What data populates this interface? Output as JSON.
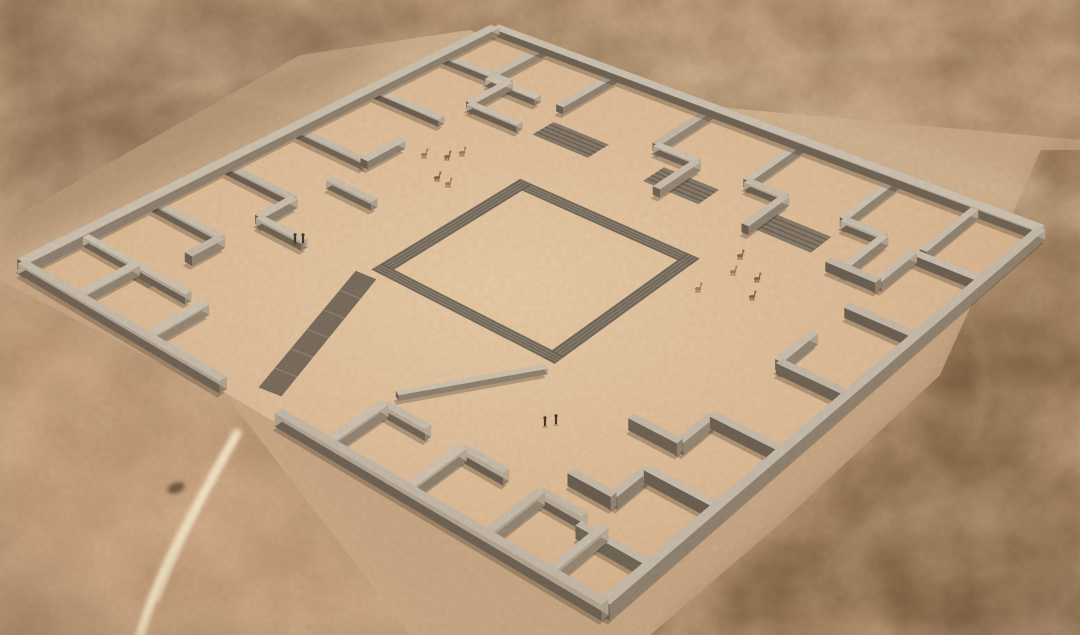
{
  "scene": {
    "label": "Aerial 3D reconstruction of a square walled desert compound with perimeter rooms, a central sunken plaza, stone stair ramps, small human figures and llamas on a sandy plain",
    "width": 1080,
    "height": 635
  },
  "palette": {
    "sand_base": "#c9a987",
    "platform_center": "#e9cda8",
    "platform_mid": "#e0bf9b",
    "platform_edge": "#d5b28c",
    "tint_topleft": "#a98c6f",
    "tint_right_dark": "#8f6f4e",
    "tint_bottomleft": "#dcb28c",
    "halo_light": "#e3cba8",
    "wall_top": "#cbc0b0",
    "wall_side_dark": "#6f6355",
    "wall_side_mid": "#948674",
    "wall_side_light": "#b6a996",
    "wall_shadow": "#3a2c1c",
    "band_fill": "#6e6659",
    "band_stripe": "#958a7c",
    "ramp_fill": "#847869",
    "ramp_stripe": "#5d5448",
    "walkway_fill": "#75695c",
    "walkway_stripe": "#9b9083",
    "path_light": "#f2e4c5",
    "path_core": "#f7ecd2",
    "trail_light": "#e8d2ae",
    "trail_dark": "#6b543c",
    "person": "#4a3828",
    "animal_a": "#a87f58",
    "animal_b": "#8f6845",
    "rock": "#4f3b28"
  },
  "geometry": {
    "corners": {
      "top": [
        495,
        33
      ],
      "right": [
        1041,
        238
      ],
      "left": [
        22,
        272
      ],
      "bottom": [
        605,
        618
      ]
    },
    "wall_defaults": {
      "thickness": 0.013,
      "height": 1.0
    },
    "outer_walls": [
      [
        0,
        0,
        1,
        0,
        0.016,
        1.1
      ],
      [
        0,
        0,
        0,
        1,
        0.016,
        1.1
      ],
      [
        1,
        0,
        1,
        1,
        0.016,
        1.1
      ],
      [
        0,
        1,
        0.345,
        1,
        0.016,
        1.1
      ],
      [
        0.44,
        1,
        1,
        1,
        0.016,
        1.1
      ]
    ],
    "inner_walls": [
      [
        0.095,
        0.008,
        0.095,
        0.125
      ],
      [
        0.225,
        0.008,
        0.225,
        0.125
      ],
      [
        0.095,
        0.125,
        0.185,
        0.125
      ],
      [
        0.4,
        0.008,
        0.4,
        0.125
      ],
      [
        0.4,
        0.125,
        0.475,
        0.125
      ],
      [
        0.565,
        0.008,
        0.565,
        0.125
      ],
      [
        0.565,
        0.125,
        0.635,
        0.125
      ],
      [
        0.74,
        0.008,
        0.74,
        0.125
      ],
      [
        0.74,
        0.125,
        0.815,
        0.125
      ],
      [
        0.885,
        0.008,
        0.885,
        0.125
      ],
      [
        0.475,
        0.125,
        0.475,
        0.215
      ],
      [
        0.635,
        0.125,
        0.635,
        0.215
      ],
      [
        0.815,
        0.125,
        0.815,
        0.215
      ],
      [
        0.008,
        0.115,
        0.125,
        0.115
      ],
      [
        0.008,
        0.26,
        0.125,
        0.26
      ],
      [
        0.125,
        0.115,
        0.125,
        0.2
      ],
      [
        0.008,
        0.425,
        0.125,
        0.425
      ],
      [
        0.125,
        0.345,
        0.125,
        0.425
      ],
      [
        0.008,
        0.575,
        0.125,
        0.575
      ],
      [
        0.125,
        0.575,
        0.125,
        0.65
      ],
      [
        0.008,
        0.73,
        0.125,
        0.73
      ],
      [
        0.125,
        0.73,
        0.125,
        0.8
      ],
      [
        0.008,
        0.875,
        0.125,
        0.875
      ],
      [
        0.125,
        0.2,
        0.215,
        0.2
      ],
      [
        0.125,
        0.5,
        0.205,
        0.5
      ],
      [
        0.125,
        0.65,
        0.205,
        0.65
      ],
      [
        0.992,
        0.135,
        0.875,
        0.135
      ],
      [
        0.992,
        0.285,
        0.875,
        0.285
      ],
      [
        0.875,
        0.135,
        0.875,
        0.215
      ],
      [
        0.992,
        0.44,
        0.875,
        0.44
      ],
      [
        0.875,
        0.36,
        0.875,
        0.44
      ],
      [
        0.992,
        0.59,
        0.875,
        0.59
      ],
      [
        0.875,
        0.59,
        0.875,
        0.665
      ],
      [
        0.992,
        0.74,
        0.875,
        0.74
      ],
      [
        0.875,
        0.74,
        0.875,
        0.815
      ],
      [
        0.992,
        0.895,
        0.875,
        0.895
      ],
      [
        0.875,
        0.215,
        0.785,
        0.215
      ],
      [
        0.875,
        0.665,
        0.79,
        0.665
      ],
      [
        0.875,
        0.815,
        0.8,
        0.815
      ],
      [
        0.095,
        0.992,
        0.095,
        0.875
      ],
      [
        0.215,
        0.992,
        0.215,
        0.875
      ],
      [
        0.095,
        0.875,
        0.185,
        0.875
      ],
      [
        0.525,
        0.992,
        0.525,
        0.875
      ],
      [
        0.525,
        0.875,
        0.6,
        0.875
      ],
      [
        0.66,
        0.992,
        0.66,
        0.875
      ],
      [
        0.66,
        0.875,
        0.735,
        0.875
      ],
      [
        0.795,
        0.992,
        0.795,
        0.875
      ],
      [
        0.905,
        0.992,
        0.905,
        0.875
      ],
      [
        0.795,
        0.875,
        0.87,
        0.875
      ]
    ],
    "low_walls": [
      [
        0.625,
        0.645,
        0.515,
        0.835,
        0.01,
        0.5
      ]
    ],
    "plaza_bands": [
      {
        "quad": [
          [
            0.3,
            0.3
          ],
          [
            0.622,
            0.3
          ],
          [
            0.622,
            0.322
          ],
          [
            0.3,
            0.322
          ]
        ],
        "stripes": 4
      },
      {
        "quad": [
          [
            0.3,
            0.3
          ],
          [
            0.3,
            0.622
          ],
          [
            0.322,
            0.622
          ],
          [
            0.322,
            0.3
          ]
        ],
        "stripes": 4
      },
      {
        "quad": [
          [
            0.622,
            0.3
          ],
          [
            0.622,
            0.622
          ],
          [
            0.6,
            0.622
          ],
          [
            0.6,
            0.3
          ]
        ],
        "stripes": 4
      },
      {
        "quad": [
          [
            0.3,
            0.622
          ],
          [
            0.622,
            0.622
          ],
          [
            0.622,
            0.6
          ],
          [
            0.3,
            0.6
          ]
        ],
        "stripes": 4
      }
    ],
    "ramps": [
      {
        "quad": [
          [
            0.235,
            0.15
          ],
          [
            0.335,
            0.15
          ],
          [
            0.335,
            0.196
          ],
          [
            0.235,
            0.196
          ]
        ],
        "stripes": 5
      },
      {
        "quad": [
          [
            0.435,
            0.15
          ],
          [
            0.535,
            0.15
          ],
          [
            0.535,
            0.196
          ],
          [
            0.435,
            0.196
          ]
        ],
        "stripes": 5
      },
      {
        "quad": [
          [
            0.64,
            0.152
          ],
          [
            0.74,
            0.152
          ],
          [
            0.74,
            0.198
          ],
          [
            0.64,
            0.198
          ]
        ],
        "stripes": 5
      }
    ],
    "walkway": {
      "quad": [
        [
          0.287,
          0.64
        ],
        [
          0.32,
          0.636
        ],
        [
          0.404,
          0.948
        ],
        [
          0.371,
          0.956
        ]
      ],
      "stripes": 6
    },
    "rock": {
      "x": 176,
      "y": 488,
      "rx": 9,
      "ry": 5,
      "rot": -22
    }
  },
  "figures": {
    "people": [
      [
        295,
        243
      ],
      [
        303,
        243
      ],
      [
        545,
        426
      ],
      [
        556,
        424
      ]
    ],
    "animals": [
      [
        424,
        157
      ],
      [
        447,
        159
      ],
      [
        462,
        155
      ],
      [
        437,
        180
      ],
      [
        448,
        186
      ],
      [
        740,
        258
      ],
      [
        733,
        274
      ],
      [
        757,
        281
      ],
      [
        698,
        291
      ],
      [
        752,
        299
      ]
    ]
  },
  "trails": {
    "light": [
      {
        "d": "M0,130 C150,100 300,62 432,30",
        "w": 6,
        "o": 0.3
      },
      {
        "d": "M0,58 C120,70 250,95 340,118",
        "w": 5,
        "o": 0.22
      },
      {
        "d": "M300,0 C340,34 390,60 452,60",
        "w": 5,
        "o": 0.28
      },
      {
        "d": "M600,95 C740,60 900,45 1080,52",
        "w": 10,
        "o": 0.22
      },
      {
        "d": "M950,300 C1000,350 995,430 945,480",
        "w": 8,
        "o": 0.12
      }
    ],
    "dark": [
      {
        "d": "M560,62 C680,34 800,26 940,20",
        "w": 4,
        "o": 0.2
      },
      {
        "d": "M690,0 C710,30 760,60 830,75",
        "w": 5,
        "o": 0.15
      }
    ],
    "entrance": [
      {
        "d": "M237,433 C205,492 162,560 140,635",
        "w": 9,
        "o": 0.95
      },
      {
        "d": "M236,436 C210,480 180,540 158,600",
        "w": 4,
        "o": 0.6
      }
    ],
    "halos": [
      {
        "d": "M500,10 L1062,218",
        "w": 42,
        "o": 0.4
      },
      {
        "d": "M480,26 L30,262",
        "w": 36,
        "o": 0.35
      }
    ]
  },
  "regions": {
    "tint_topleft_poly": "0,0 430,0 300,145 0,262",
    "tint_right_poly": "1041,170 1080,120 1080,635 660,635 800,510 950,370",
    "tint_bottomleft_poly": "0,300 240,410 420,635 0,635",
    "blotch_top_poly": "0,0 1080,0 1080,140 640,100 470,30 300,55 0,225",
    "blotch_right_poly": "1041,150 1080,150 1080,635 650,635 790,515 940,375",
    "blotch_bl_poly": "0,280 230,400 410,635 0,635"
  }
}
